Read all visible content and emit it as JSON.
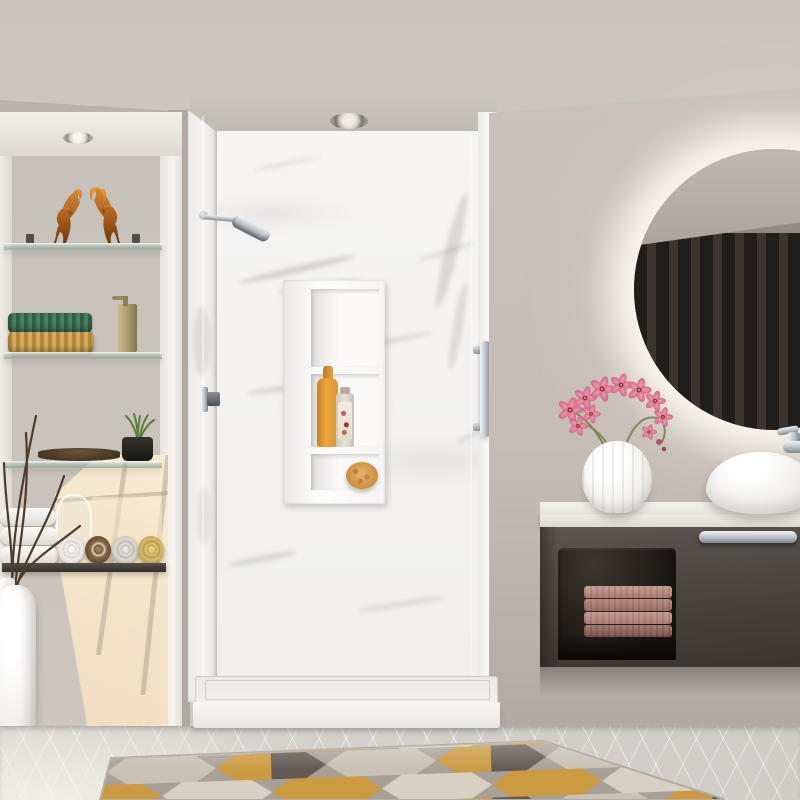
{
  "scene": {
    "type": "3d-interior-render",
    "room": "bathroom",
    "description": "Modern bathroom with white marble walk-in shower, recessed shelving niche with decor, floating dark vanity with vessel sink and round backlit mirror, geometric rug on light tile floor"
  },
  "palette": {
    "ceiling": "#cdc8c2",
    "left_wall": "#b6b0a9",
    "right_wall": "#c9c0b9",
    "niche_back": "#c8c3bc",
    "niche_trim": "#efece7",
    "sunlight_patch": "#f7e8cc",
    "marble": "#f5f4f2",
    "marble_vein": "#9d9a96",
    "chrome": "#ccd0d4",
    "brass": "#ae9d6d",
    "amber_glass": "#c07a2a",
    "glass_shelf": "#9fb4a6",
    "wood_shelf": "#3e3a35",
    "shampoo_orange": "#e39b3b",
    "sponge": "#d69a4e",
    "vanity_body": "#4e4844",
    "vanity_interior": "#272320",
    "vanity_towels": "#c0948b",
    "countertop": "#ece8e3",
    "orchid_pink": "#d9718f",
    "floor_tile": "#d7d4cf",
    "rug_mustard": "#cc9a41",
    "rug_charcoal": "#615a52",
    "rug_cream": "#d6d0c2",
    "rug_gray": "#a7a096"
  },
  "objects": {
    "ceiling": "Ceiling",
    "ceiling_light": "Recessed ceiling spotlight",
    "niche": "Built-in wall niche with shelves",
    "niche_light": "Recessed niche spotlight",
    "glass_shelf": "Glass display shelf",
    "horse_figurines": "Amber glass horse figurines",
    "woven_towels": "Folded woven towels, green and tan",
    "soap_dispenser": "Brass soap dispenser",
    "plant_pot": "Black pot with green grass plant",
    "plates": "Stacked dark plates",
    "rolled_towels": "Rolled towels in white, brown, gray and yellow",
    "folded_towels": "Stack of folded white towels",
    "glass_carafe": "Glass carafe",
    "floor_vase": "White floor vase with dry branches",
    "branches": "Decorative dry branches",
    "sunlight": "Warm window light patch",
    "shower": "Walk-in marble shower",
    "shower_head": "Chrome wall-mounted shower head",
    "shower_niche": "Recessed shower storage niche",
    "shampoo_bottle": "Orange shampoo bottle",
    "conditioner_bottle": "Clear bottle with floral label",
    "sponge": "Round bath sponge",
    "door_handle": "Chrome glass-door handle bar",
    "door_hinge": "Chrome glass-door hinge",
    "shower_tray": "Low-profile white shower base",
    "mirror": "Round backlit mirror reflecting slatted wall",
    "faucet": "Chrome wall-mounted faucet",
    "sink": "White vessel sink",
    "countertop": "White stone countertop",
    "vanity": "Floating dark-brown vanity cabinet",
    "vanity_towels": "Folded mauve towels in open shelf",
    "vanity_handle": "Chrome drawer pull",
    "orchid": "Pink orchid arrangement",
    "orchid_vase": "White ribbed vase",
    "rug": "Geometric rug in mustard, charcoal, gray and cream",
    "floor": "Light gray tile floor"
  }
}
